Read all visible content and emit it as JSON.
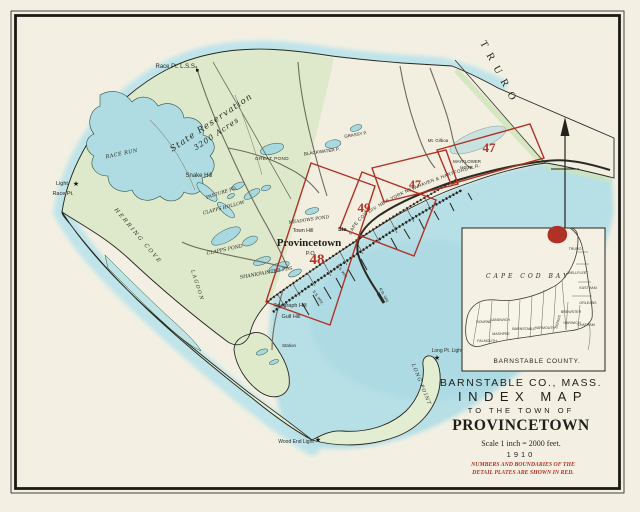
{
  "colors": {
    "paper": "#f3f0e3",
    "water": "#b7dfe6",
    "water_deep": "#a5d7df",
    "land_green": "#d9e8c6",
    "spit_green": "#e3edd2",
    "plate_red": "#b03226",
    "ink": "#26261f"
  },
  "labels": {
    "race_pt_lss": "Race Pt. L.S.S.",
    "race_run": "RACE RUN",
    "light": "Light",
    "race_pt": "Race Pt.",
    "state_reservation_1": "State Reservation",
    "state_reservation_2": "3200 Acres",
    "snake_hill": "Snake Hill",
    "pasture_pd": "PASTURE PD.",
    "clapps_hollow": "CLAPPS HOLLOW",
    "great_pond": "GREAT POND",
    "blackwater_p": "BLACKWATER P.",
    "grassy_p": "GRASSY P.",
    "clapps_pond": "CLAPPS POND",
    "shankpainter_pds": "SHANKPAINTER PDS.",
    "meadows_pond": "MEADOWS POND",
    "town_hill": "Town Hill",
    "provincetown": "Provincetown",
    "po": "P.O.",
    "sta": "Sta.",
    "telegraph_hill": "Telegraph Hill",
    "gull_hill": "Gull Hill",
    "station": "Station",
    "herring_cove": "HERRING COVE",
    "lagoon": "LAGOON",
    "long_pt_light": "Long Pt. Light",
    "long_point": "LONG POINT",
    "wood_end_light": "Wood End Light",
    "truro": "TRURO",
    "mt_gilboa": "Mt. Gilboa",
    "mayflower_1": "MAYFLOWER",
    "mayflower_2": "HGTS.",
    "railroad": "CAPE COD DIV.   NEW YORK NEW HAVEN & HARTFORD R.R.",
    "ss_whf_1": "S.S. Whf.",
    "ss_whf_2": "S.S. Whf.",
    "rr_whf": "R.R. Whf."
  },
  "plates": {
    "p48": "48",
    "p49": "49",
    "p47b": "47",
    "p47a": "47"
  },
  "inset": {
    "bay": "CAPE COD BAY",
    "county": "BARNSTABLE COUNTY.",
    "towns": {
      "truro": "TRURO",
      "wellfleet": "WELLFLEET",
      "eastham": "EASTHAM",
      "orleans": "ORLEANS",
      "brewster": "BREWSTER",
      "chatham": "CHATHAM",
      "harwich": "HARWICH",
      "dennis": "DENNIS",
      "yarmouth": "YARMOUTH",
      "barnstable": "BARNSTABLE",
      "sandwich": "SANDWICH",
      "bourne": "BOURNE",
      "mashpee": "MASHPEE",
      "falmouth": "FALMOUTH"
    }
  },
  "title": {
    "county": "BARNSTABLE CO., MASS.",
    "map_title": "INDEX MAP",
    "subtitle": "TO THE TOWN OF",
    "town": "PROVINCETOWN",
    "scale": "Scale 1 inch = 2000 feet.",
    "year": "1910",
    "note1": "NUMBERS AND BOUNDARIES OF THE",
    "note2": "DETAIL PLATES ARE SHOWN IN RED."
  }
}
